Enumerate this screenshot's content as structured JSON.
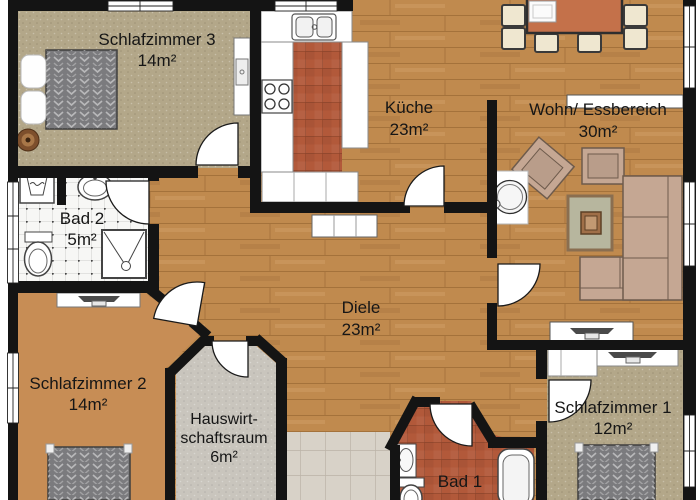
{
  "rooms": {
    "schlafzimmer3": {
      "name": "Schlafzimmer 3",
      "area": "14m²"
    },
    "kueche": {
      "name": "Küche",
      "area": "23m²"
    },
    "wohn_essbereich": {
      "name": "Wohn/ Essbereich",
      "area": "30m²"
    },
    "bad2": {
      "name": "Bad 2",
      "area": "5m²"
    },
    "diele": {
      "name": "Diele",
      "area": "23m²"
    },
    "schlafzimmer2": {
      "name": "Schlafzimmer 2",
      "area": "14m²"
    },
    "hauswirtschaftsraum": {
      "name_line1": "Hauswirt-",
      "name_line2": "schaftsraum",
      "area": "6m²"
    },
    "bad1": {
      "name": "Bad 1"
    },
    "schlafzimmer1": {
      "name": "Schlafzimmer 1",
      "area": "12m²"
    }
  },
  "colors": {
    "wall": "#141414",
    "wood_floor": "#c08a4e",
    "carpet_beige": "#b3a789",
    "floor_orange": "#c78d55",
    "floor_gray": "#c9c5bd",
    "tile_terracotta": "#b2593a",
    "tile_white": "#f7f7f5",
    "tile_hall": "#d8d2c8",
    "furniture_tan": "#c5a793",
    "table_orange": "#c4714a",
    "chair_cream": "#efe7d0",
    "bed_gray": "#7b7b7e",
    "rug_green": "#b7b69e"
  }
}
